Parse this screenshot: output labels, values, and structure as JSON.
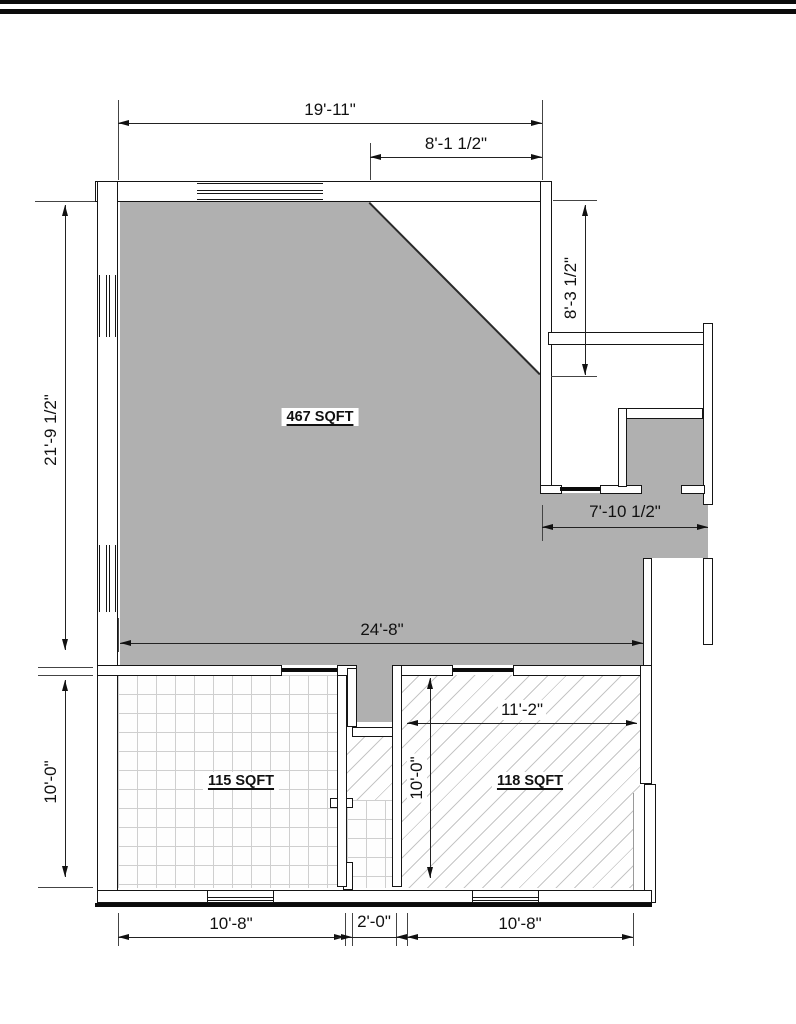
{
  "page": {
    "background": "#ffffff",
    "top_bar_color": "#000000"
  },
  "plan": {
    "colors": {
      "room_fill": "#b0b0b0",
      "wall_line": "#151515",
      "hatch_line": "#c6c6c6",
      "tile_line": "#cfcfcf"
    },
    "rooms": [
      {
        "id": "main",
        "label": "467 SQFT",
        "area_sqft": 467,
        "floor": "solid-gray"
      },
      {
        "id": "bottom_left",
        "label": "115 SQFT",
        "area_sqft": 115,
        "floor": "tile-grid"
      },
      {
        "id": "bottom_right",
        "label": "118 SQFT",
        "area_sqft": 118,
        "floor": "diagonal-hatch"
      }
    ],
    "dimensions": [
      {
        "id": "top_width",
        "text": "19'-11\"",
        "orientation": "horizontal"
      },
      {
        "id": "top_right_partial",
        "text": "8'-1 1/2\"",
        "orientation": "horizontal"
      },
      {
        "id": "right_upper_height",
        "text": "8'-3 1/2\"",
        "orientation": "vertical"
      },
      {
        "id": "passage_width",
        "text": "7'-10 1/2\"",
        "orientation": "horizontal"
      },
      {
        "id": "main_width",
        "text": "24'-8\"",
        "orientation": "horizontal"
      },
      {
        "id": "room118_width",
        "text": "11'-2\"",
        "orientation": "horizontal"
      },
      {
        "id": "left_main_height",
        "text": "21'-9 1/2\"",
        "orientation": "vertical"
      },
      {
        "id": "left_lower_height",
        "text": "10'-0\"",
        "orientation": "vertical"
      },
      {
        "id": "corridor_height",
        "text": "10'-0\"",
        "orientation": "vertical"
      },
      {
        "id": "bottom_left_width",
        "text": "10'-8\"",
        "orientation": "horizontal"
      },
      {
        "id": "bottom_center_width",
        "text": "2'-0\"",
        "orientation": "horizontal"
      },
      {
        "id": "bottom_right_width",
        "text": "10'-8\"",
        "orientation": "horizontal"
      }
    ]
  }
}
